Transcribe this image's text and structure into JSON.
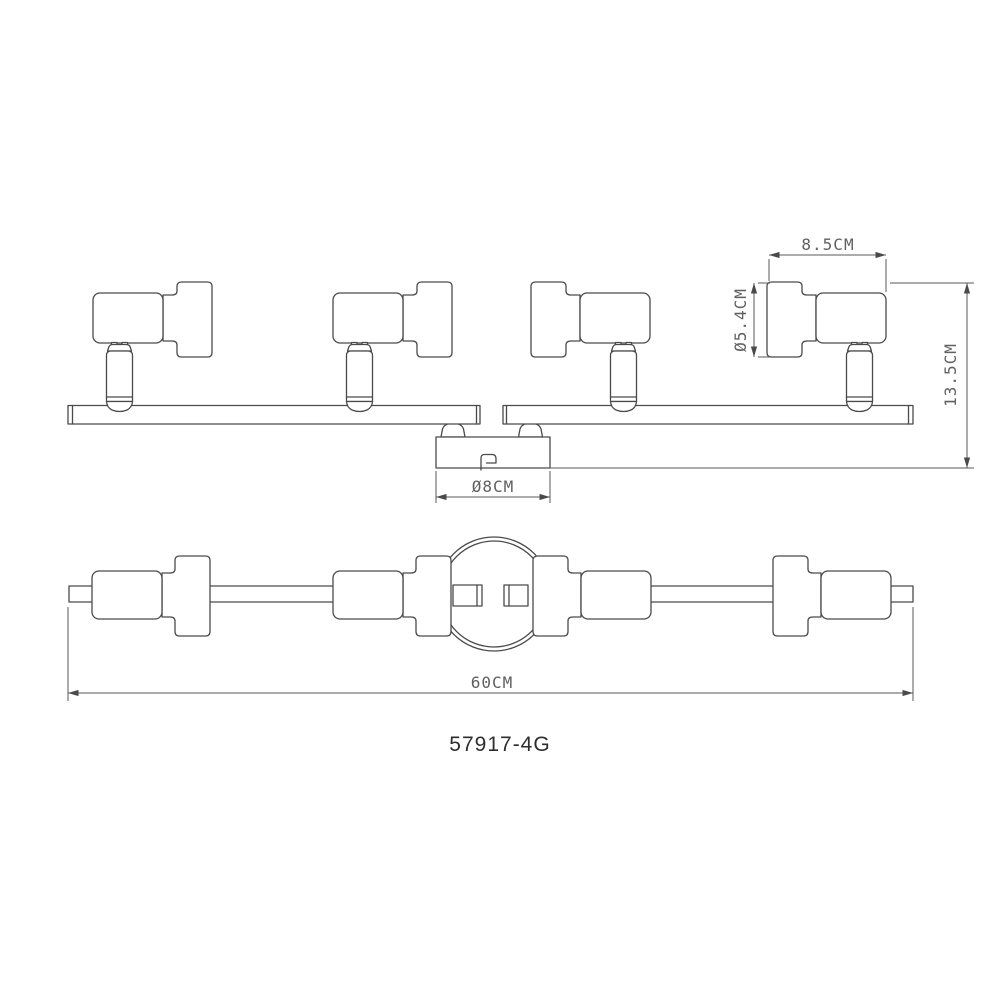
{
  "title": {
    "model_number": "57917-4G"
  },
  "dimensions": {
    "head_width": "8.5CM",
    "head_diameter": "Ø5.4CM",
    "overall_height": "13.5CM",
    "canopy_diameter": "Ø8CM",
    "overall_length": "60CM"
  },
  "fixture": {
    "spot_count": 4,
    "views": [
      "front-elevation",
      "plan-view"
    ]
  },
  "colors": {
    "background": "#ffffff",
    "outline": "#4a4a4a",
    "dimension_line": "#5a5a5a",
    "dimension_text": "#606060",
    "model_text": "#2e2e2e"
  }
}
